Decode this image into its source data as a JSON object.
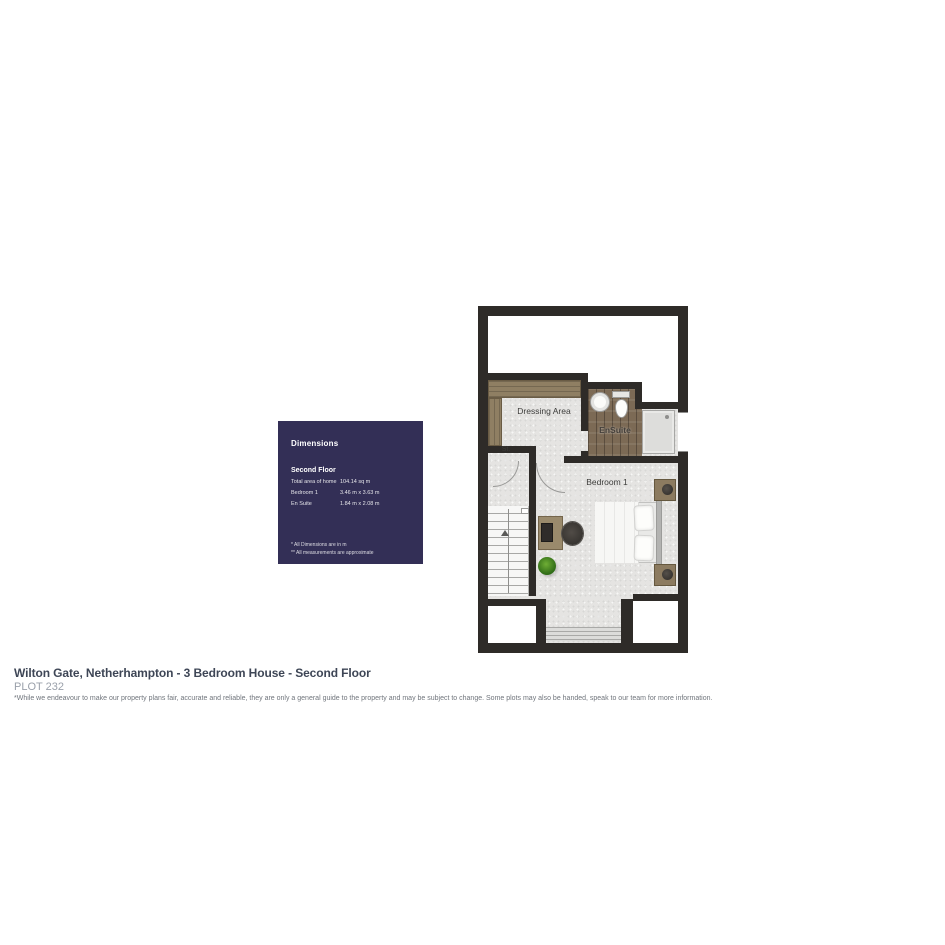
{
  "floor_plan": {
    "rooms": [
      {
        "name": "Dressing Area"
      },
      {
        "name": "St."
      },
      {
        "name": "EnSuite"
      },
      {
        "name": "Bedroom 1"
      }
    ]
  },
  "dimensions_panel": {
    "title": "Dimensions",
    "floor_label": "Second Floor",
    "rows": [
      {
        "label": "Total area of home",
        "value": "104.14 sq m"
      },
      {
        "label": "Bedroom 1",
        "value": "3.46 m x 3.63 m"
      },
      {
        "label": "En Suite",
        "value": "1.84 m x 2.08 m"
      }
    ],
    "footnotes": [
      "* All Dimensions are in m",
      "** All measurements are approximate"
    ],
    "panel_color": "#332f56"
  },
  "footer": {
    "title": "Wilton Gate, Netherhampton - 3 Bedroom House - Second Floor",
    "plot": "PLOT 232",
    "disclaimer": "*While we endeavour to make our property plans fair, accurate and reliable, they are only a general guide to the property and may be subject to change. Some plots may also be handed, speak to our team for more information."
  },
  "colors": {
    "wall": "#2e2b28",
    "floor": "#e5e4e2",
    "wood_floor": "#7c6a55",
    "wardrobe": "#8f7f63",
    "panel": "#332f56"
  }
}
